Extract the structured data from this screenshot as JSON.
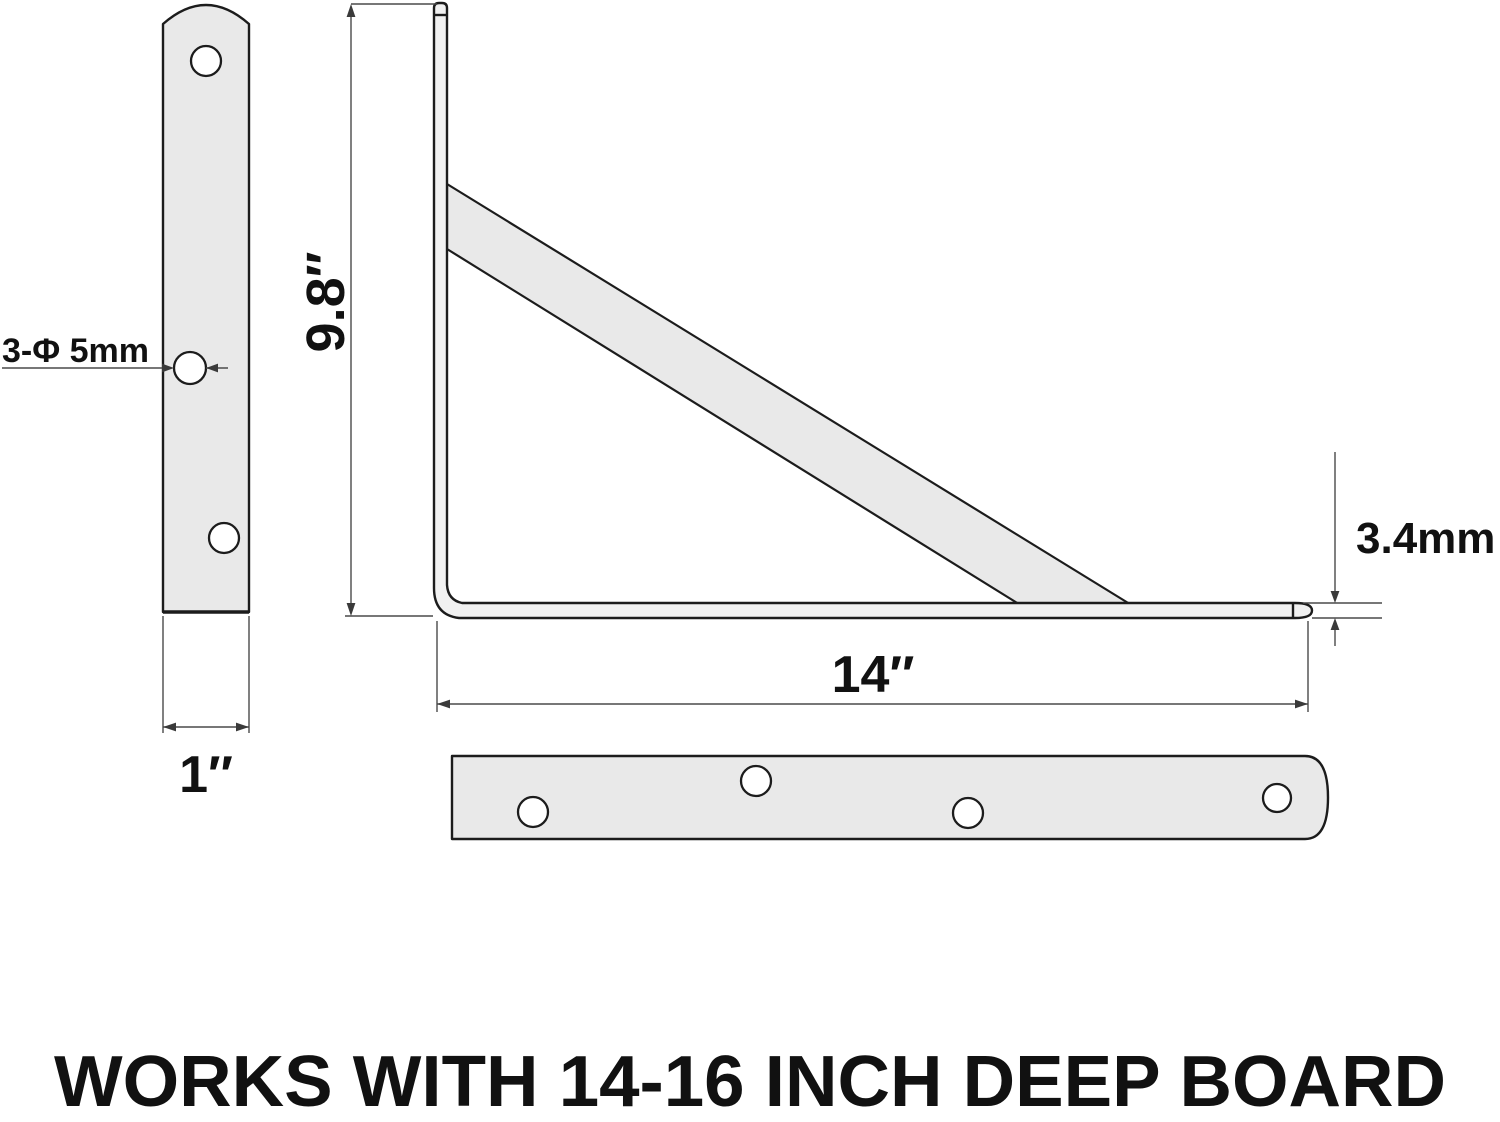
{
  "caption": "WORKS WITH 14-16 INCH DEEP BOARD",
  "labels": {
    "hole_spec": "3-Φ 5mm",
    "height": "9.8″",
    "plate_width": "1″",
    "arm_length": "14″",
    "thickness": "3.4mm"
  },
  "views": {
    "side_plate": "wall plate side view with 3 staggered holes",
    "profile": "L-bracket profile with diagonal brace",
    "arm_plan": "shelf arm top view with 4 staggered holes"
  },
  "colors": {
    "outline": "#1c1c1c",
    "metal_fill": "#e9e9e9",
    "profile_fill": "#f1f1f1",
    "dimension_line": "#4a4a4a",
    "text": "#111111",
    "background": "#ffffff"
  }
}
